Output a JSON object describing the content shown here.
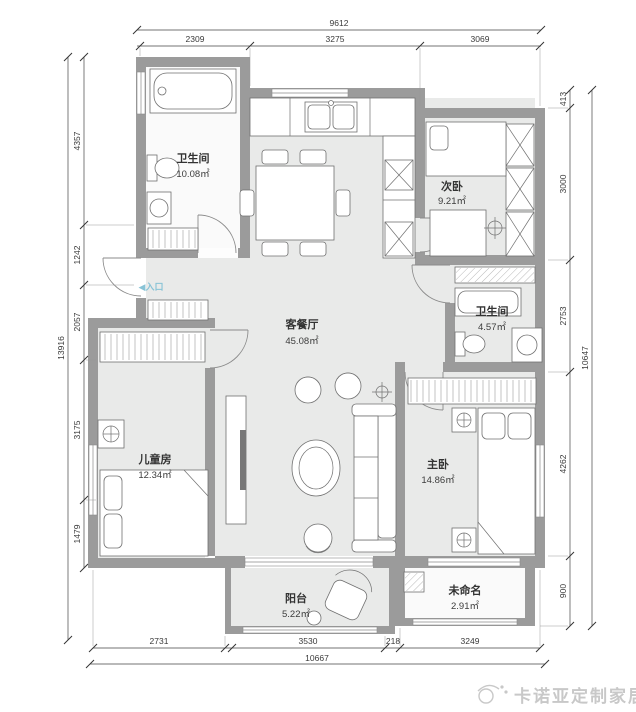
{
  "rooms": {
    "wc1": {
      "name": "卫生间",
      "area": "10.08㎡"
    },
    "second_bedroom": {
      "name": "次卧",
      "area": "9.21㎡"
    },
    "living_dining": {
      "name": "客餐厅",
      "area": "45.08㎡"
    },
    "wc2": {
      "name": "卫生间",
      "area": "4.57㎡"
    },
    "kids_room": {
      "name": "儿童房",
      "area": "12.34㎡"
    },
    "master_bedroom": {
      "name": "主卧",
      "area": "14.86㎡"
    },
    "balcony": {
      "name": "阳台",
      "area": "5.22㎡"
    },
    "unnamed": {
      "name": "未命名",
      "area": "2.91㎡"
    }
  },
  "entrance": {
    "label": "◀入口"
  },
  "dimensions": {
    "top": {
      "overall": "9612",
      "segments": [
        "2309",
        "3275",
        "3069"
      ]
    },
    "left": {
      "overall": "13916",
      "segments": [
        "4357",
        "1242",
        "2057",
        "3175",
        "1479"
      ]
    },
    "right": {
      "overall": "10647",
      "segments": [
        "413",
        "3000",
        "2753",
        "4262",
        "900"
      ]
    },
    "bottom": {
      "overall": "10667",
      "segments": [
        "2731",
        "3530",
        "218",
        "3249"
      ]
    }
  },
  "watermark": {
    "text": "卡诺亚定制家居"
  },
  "colors": {
    "wall": "#9b9b9b",
    "floor": "#e9eae9",
    "fixture_stroke": "#707070",
    "dimension_text": "#3a3a3a",
    "entrance_text": "#88c3d6",
    "watermark": "#c8c8c8"
  }
}
